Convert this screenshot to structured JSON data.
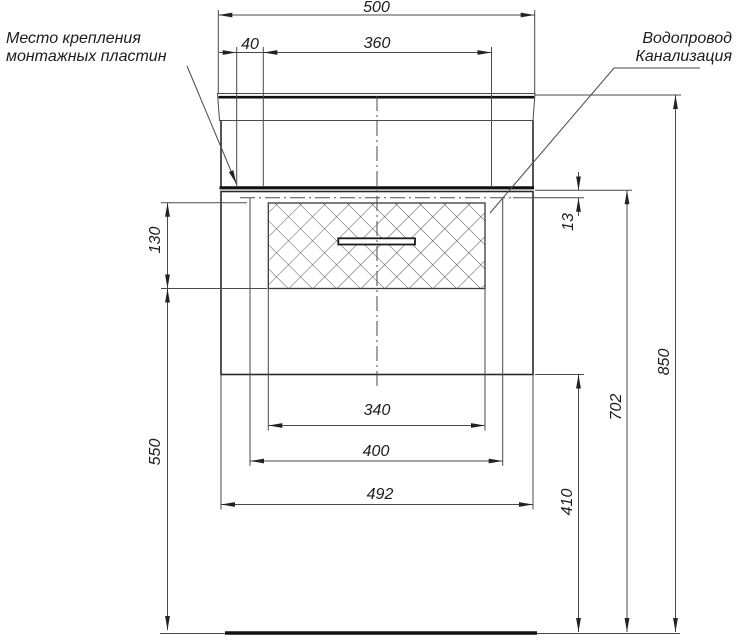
{
  "drawing": {
    "annotations": {
      "mounting_plates_line1": "Место крепления",
      "mounting_plates_line2": "монтажных пластин",
      "plumbing_line1": "Водопровод",
      "plumbing_line2": "Канализация"
    },
    "dimensions": {
      "overall_width": "500",
      "mounting_span": "360",
      "plate_offset": "40",
      "top_offset": "13",
      "hatch_height": "130",
      "hatch_width": "340",
      "inner_width": "400",
      "cabinet_width": "492",
      "clearance_height": "550",
      "bottom_height": "410",
      "mounting_height": "702",
      "overall_height": "850"
    },
    "colors": {
      "line": "#4a4a4a",
      "outline": "#2a2a2a",
      "thick_line": "#101010",
      "background": "#ffffff"
    }
  }
}
